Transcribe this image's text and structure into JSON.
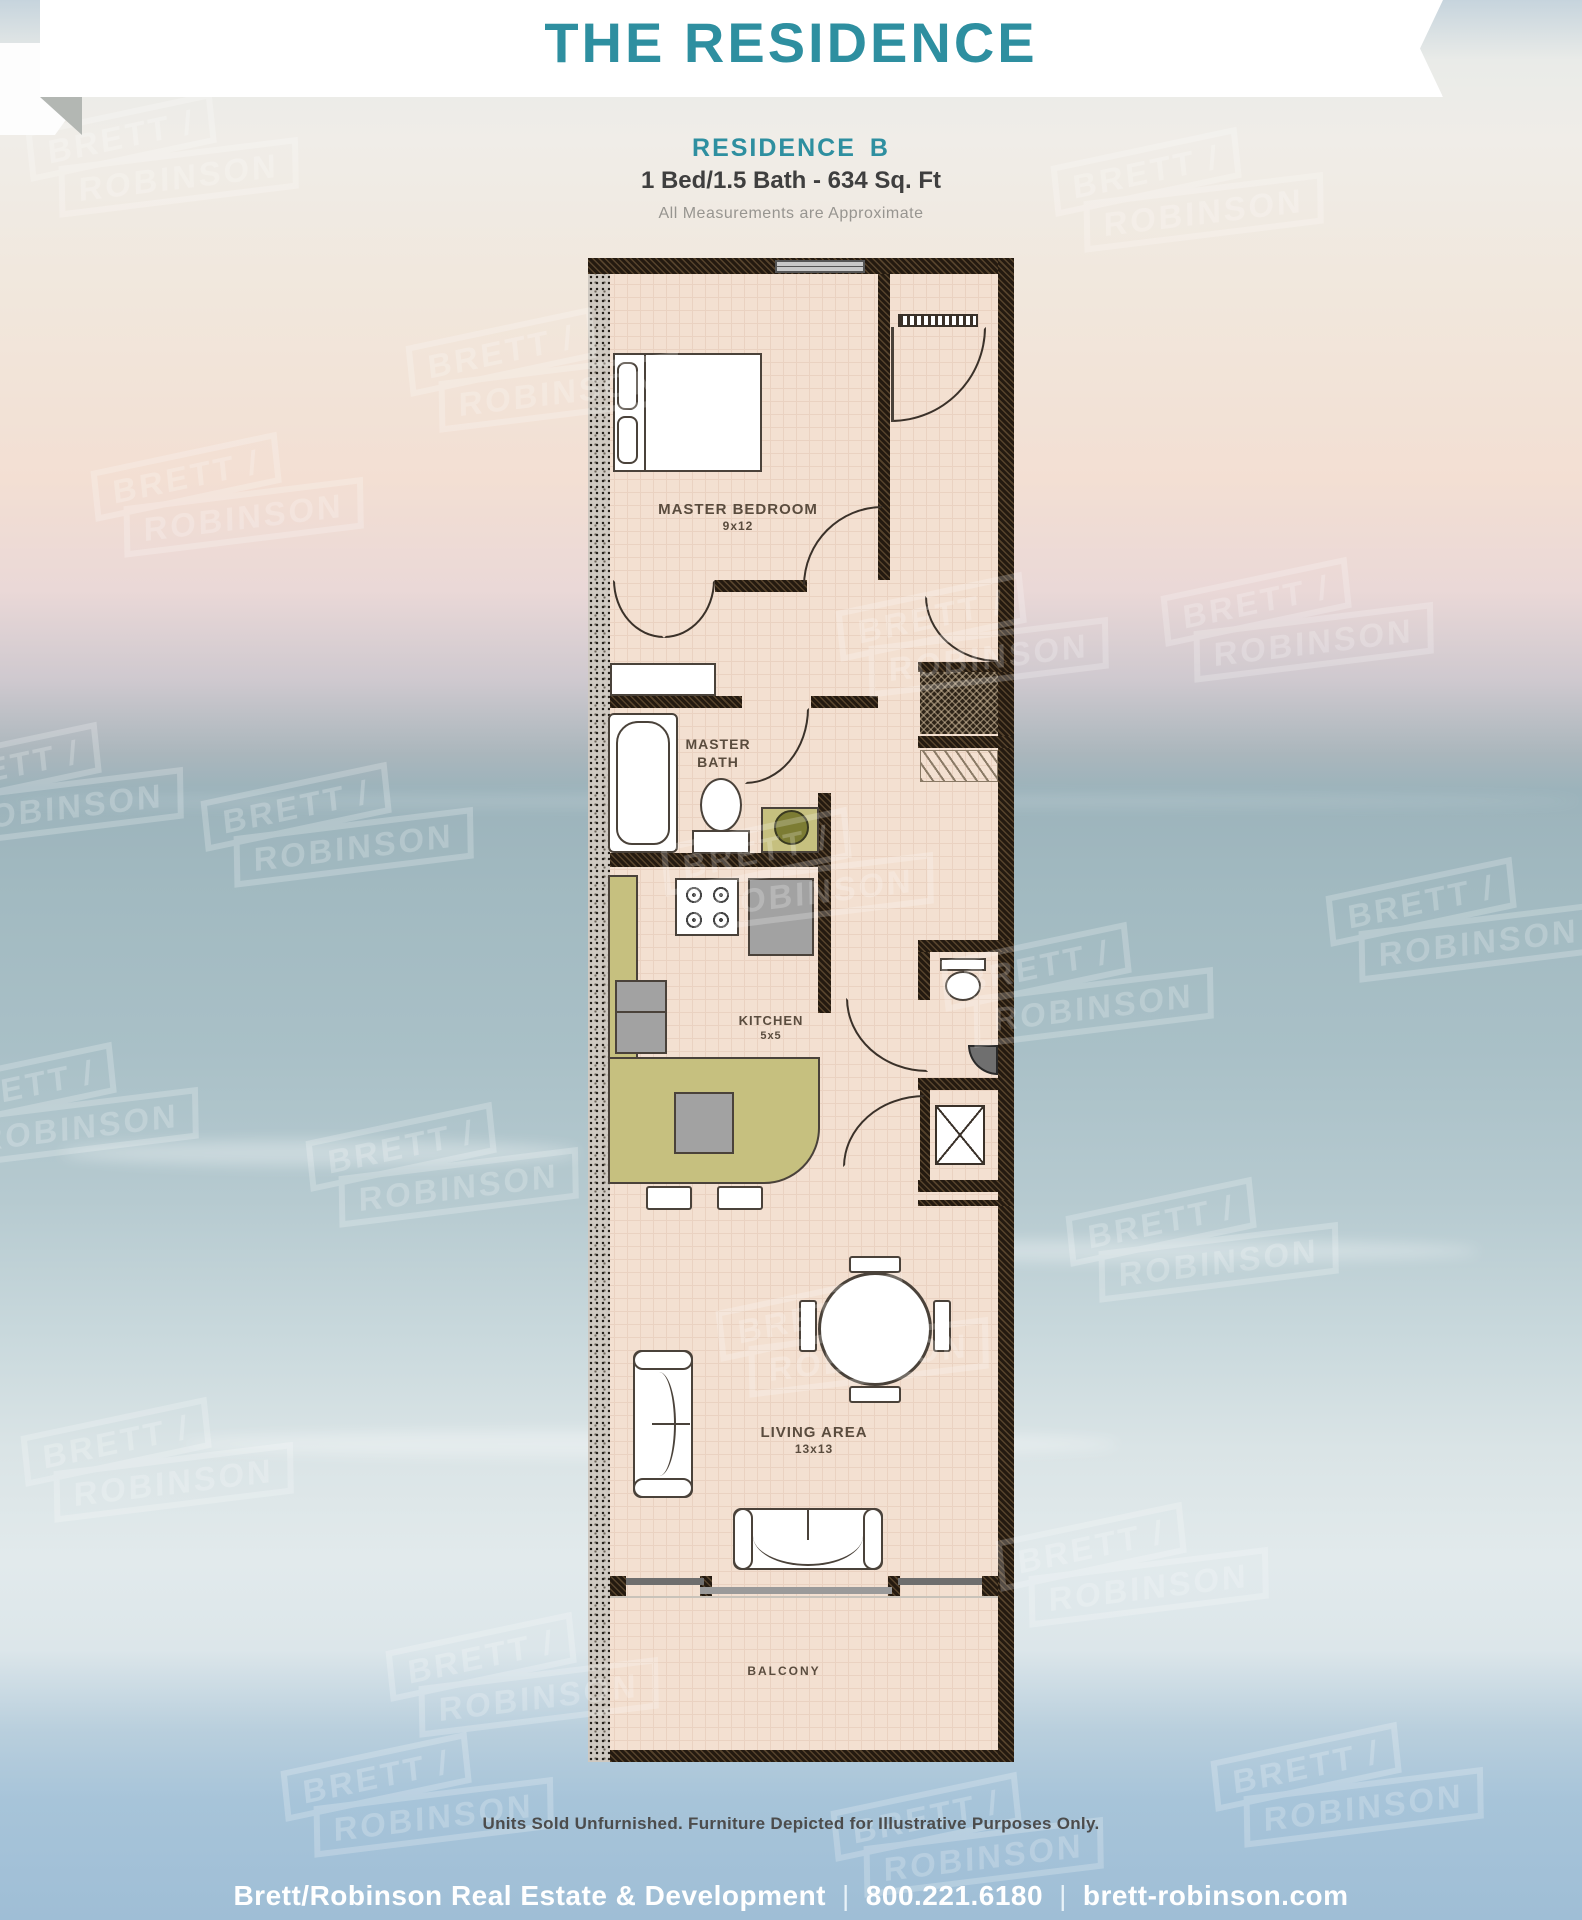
{
  "header": {
    "banner_title": "THE RESIDENCE"
  },
  "subheader": {
    "residence_label": "RESIDENCE",
    "residence_unit": "B",
    "specs": "1 Bed/1.5 Bath - 634 Sq. Ft",
    "note": "All Measurements are Approximate"
  },
  "floorplan": {
    "master_bedroom": {
      "name": "MASTER BEDROOM",
      "dims": "9x12"
    },
    "master_bath": {
      "line1": "MASTER",
      "line2": "BATH"
    },
    "kitchen": {
      "name": "KITCHEN",
      "dims": "5x5"
    },
    "living": {
      "name": "LIVING AREA",
      "dims": "13x13"
    },
    "balcony": {
      "name": "BALCONY"
    }
  },
  "watermark": {
    "line1": "BRETT /",
    "line2": "ROBINSON"
  },
  "footer": {
    "disclaimer": "Units Sold Unfurnished. Furniture Depicted for Illustrative Purposes Only.",
    "company": "Brett/Robinson Real Estate & Development",
    "separator": "|",
    "phone": "800.221.6180",
    "website": "brett-robinson.com"
  },
  "colors": {
    "accent_teal": "#2e8fa0",
    "wall_dark": "#241a10",
    "floor_tan": "#f3e0d1",
    "counter_khaki": "#c6c07f",
    "ocean_blue": "#a7c4d9"
  }
}
